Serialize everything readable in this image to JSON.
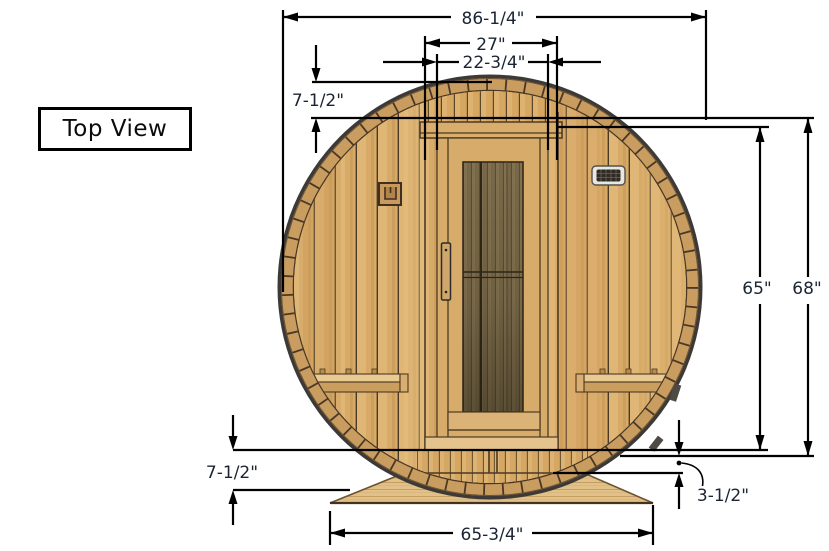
{
  "title": {
    "label": "Top View"
  },
  "dimensions": {
    "overall_width": "86-1/4\"",
    "cap_width": "27\"",
    "door_width": "22-3/4\"",
    "cap_height": "7-1/2\"",
    "body_height": "65\"",
    "total_height": "68\"",
    "floor_height": "7-1/2\"",
    "base_gap": "3-1/2\"",
    "base_width": "65-3/4\""
  },
  "colors": {
    "background": "#ffffff",
    "dimension_line": "#000000",
    "dimension_text": "#1b2433",
    "rim_edge": "#3d3936",
    "wood_mid": "#c99c5f",
    "wood_light": "#d8aa67",
    "wood_outline": "#4d3a22",
    "glass": "#786849",
    "base_wood": "#e2c189"
  }
}
